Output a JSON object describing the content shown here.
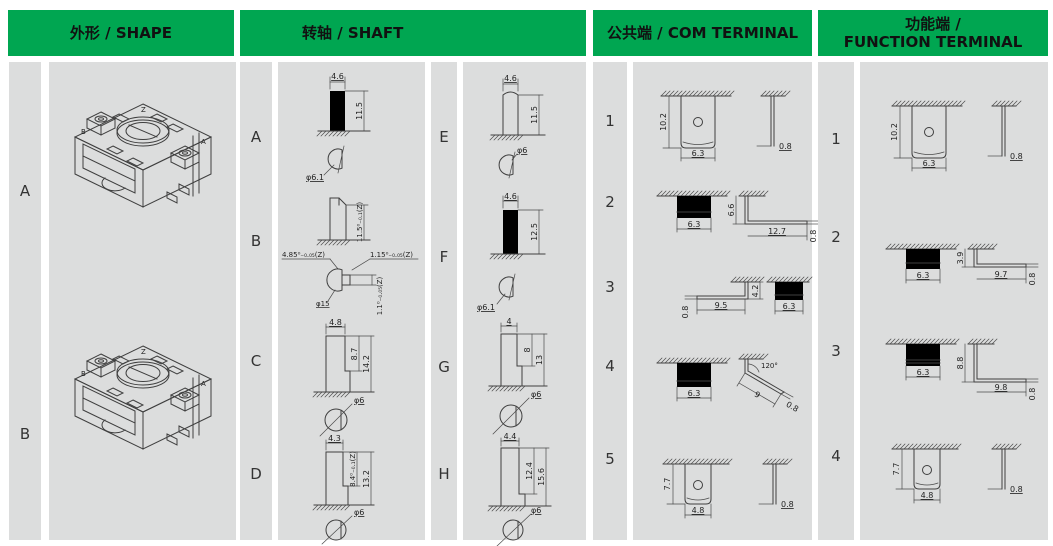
{
  "header": {
    "shape": "外形 / SHAPE",
    "shaft": "转轴 / SHAFT",
    "com": "公共端 / COM TERMINAL",
    "function_line1": "功能端 /",
    "function_line2": "FUNCTION TERMINAL"
  },
  "colors": {
    "header_green": "#00a651",
    "panel_gray": "#dcdddd",
    "line": "#3f3f3f"
  },
  "shape": {
    "rows": [
      {
        "label": "A"
      },
      {
        "label": "B"
      }
    ],
    "marks": {
      "z": "Z",
      "a": "A",
      "b": "B"
    }
  },
  "shaft_left": {
    "rows": [
      {
        "label": "A",
        "top_width": "4.6",
        "height": "11.5",
        "section_dia": "φ6.1"
      },
      {
        "label": "B",
        "height": "11.5⁰₋₀.₁(Z)",
        "sec_left": "4.85⁰₋₀.₀₅(Z)",
        "sec_right": "1.15⁰₋₀.₀₅(Z)",
        "sec_dia": "φ15",
        "sec_depth": "1.1⁰₋₀.₀₅(Z)"
      },
      {
        "label": "C",
        "top_width": "4.8",
        "flat_len": "8.7",
        "total_len": "14.2",
        "section_dia": "φ6"
      },
      {
        "label": "D",
        "top_width": "4.3",
        "flat_len": "8.4⁰₋₀.₁(Z)",
        "total_len": "13.2",
        "section_dia": "φ6"
      }
    ]
  },
  "shaft_right": {
    "rows": [
      {
        "label": "E",
        "top_width": "4.6",
        "height": "11.5",
        "section_dia": "φ6"
      },
      {
        "label": "F",
        "top_width": "4.6",
        "height": "12.5",
        "section_dia": "φ6.1"
      },
      {
        "label": "G",
        "top_width": "4",
        "flat_len": "8",
        "total_len": "13",
        "section_dia": "φ6"
      },
      {
        "label": "H",
        "top_width": "4.4",
        "flat_len": "12.4",
        "total_len": "15.6",
        "section_dia": "φ6"
      }
    ]
  },
  "com": {
    "rows": [
      {
        "label": "1",
        "height": "10.2",
        "width": "6.3",
        "thickness": "0.8"
      },
      {
        "label": "2",
        "width": "6.3",
        "drop": "6.6",
        "run": "12.7",
        "thickness": "0.8"
      },
      {
        "label": "3",
        "thickness": "0.8",
        "run": "9.5",
        "rise": "4.2",
        "width": "6.3"
      },
      {
        "label": "4",
        "width": "6.3",
        "angle": "120°",
        "length": "9",
        "thickness": "0.8"
      },
      {
        "label": "5",
        "height": "7.7",
        "width": "4.8",
        "thickness": "0.8"
      }
    ]
  },
  "function": {
    "rows": [
      {
        "label": "1",
        "height": "10.2",
        "width": "6.3",
        "thickness": "0.8"
      },
      {
        "label": "2",
        "width": "6.3",
        "drop": "3.9",
        "run": "9.7",
        "thickness": "0.8"
      },
      {
        "label": "3",
        "width": "6.3",
        "drop": "8.8",
        "run": "9.8",
        "thickness": "0.8"
      },
      {
        "label": "4",
        "height": "7.7",
        "width": "4.8",
        "thickness": "0.8"
      }
    ]
  }
}
